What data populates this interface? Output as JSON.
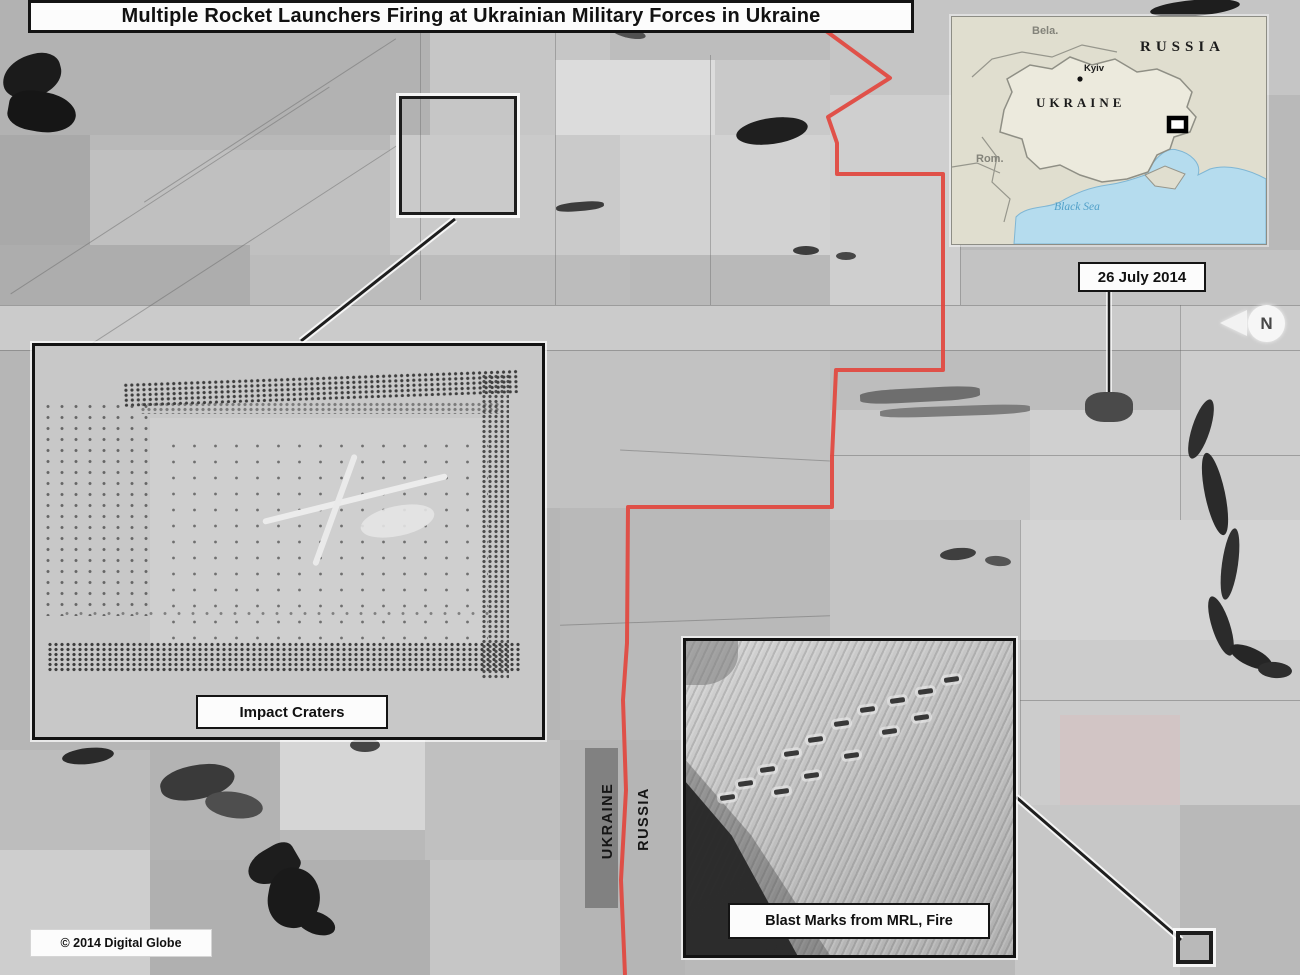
{
  "title": "Multiple Rocket Launchers Firing at Ukrainian Military Forces in Ukraine",
  "date_label": "26 July 2014",
  "copyright": "© 2014 Digital Globe",
  "north_indicator": "N",
  "border_labels": {
    "west": "UKRAINE",
    "east": "RUSSIA"
  },
  "callouts": {
    "impact": "Impact Craters",
    "blast": "Blast Marks from MRL, Fire"
  },
  "inset_map": {
    "russia": "RUSSIA",
    "ukraine": "UKRAINE",
    "belarus_abbr": "Bela.",
    "romania_abbr": "Rom.",
    "capital": "Kyiv",
    "sea": "Black Sea"
  },
  "colors": {
    "border_line_red": "#e2463e",
    "map_sea_blue": "#b5dcee",
    "map_land_beige": "#e0decf",
    "annotation_black": "#141414"
  }
}
